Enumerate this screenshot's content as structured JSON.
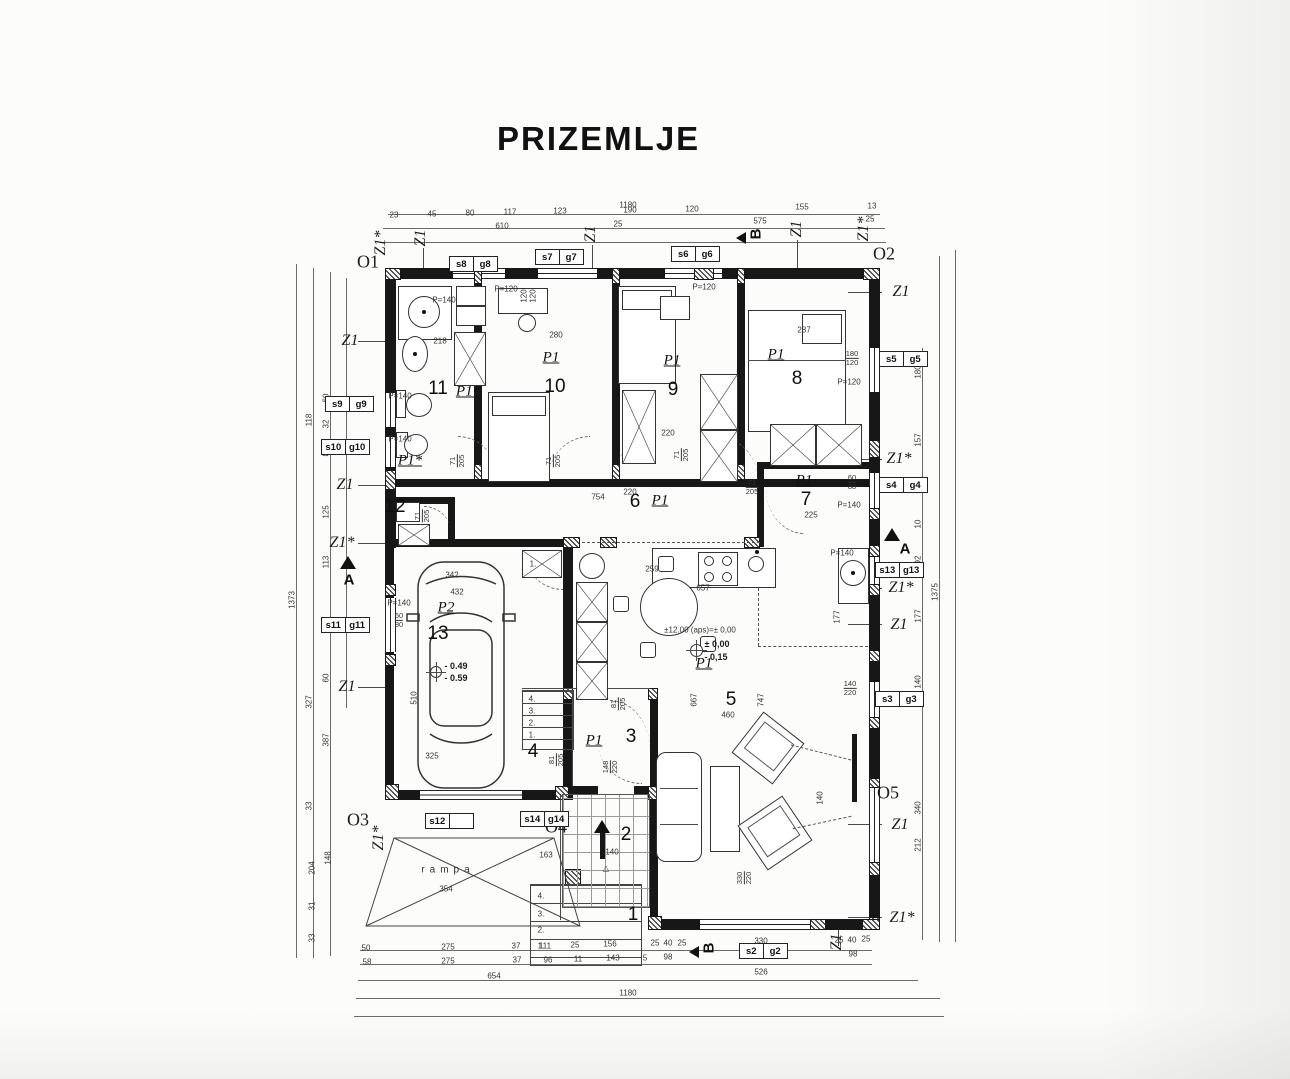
{
  "title": "PRIZEMLJE",
  "plan": {
    "floor_name": "PRIZEMLJE",
    "rooms": [
      {
        "number": "1",
        "type": ""
      },
      {
        "number": "2",
        "type": ""
      },
      {
        "number": "3",
        "type": "P1"
      },
      {
        "number": "4",
        "type": ""
      },
      {
        "number": "5",
        "type": "P1"
      },
      {
        "number": "6",
        "type": "P1"
      },
      {
        "number": "7",
        "type": "P1"
      },
      {
        "number": "8",
        "type": "P1"
      },
      {
        "number": "9",
        "type": "P1"
      },
      {
        "number": "10",
        "type": "P1"
      },
      {
        "number": "11",
        "type": "P1*"
      },
      {
        "number": "12",
        "type": "P1*"
      },
      {
        "number": "13",
        "type": "P2"
      }
    ],
    "ramp_label": "rampa"
  },
  "colors": {
    "ink": "#171717",
    "dim": "#4a4a4a",
    "paper": "#fcfcfb"
  },
  "tags": [
    {
      "a": "s8",
      "b": "g8",
      "x": 450,
      "y": 256
    },
    {
      "a": "s7",
      "b": "g7",
      "x": 536,
      "y": 249
    },
    {
      "a": "s6",
      "b": "g6",
      "x": 672,
      "y": 246
    },
    {
      "a": "s9",
      "b": "g9",
      "x": 326,
      "y": 396
    },
    {
      "a": "s10",
      "b": "g10",
      "x": 322,
      "y": 439
    },
    {
      "a": "s11",
      "b": "g11",
      "x": 322,
      "y": 617
    },
    {
      "a": "s5",
      "b": "g5",
      "x": 880,
      "y": 351
    },
    {
      "a": "s4",
      "b": "g4",
      "x": 880,
      "y": 477
    },
    {
      "a": "s13",
      "b": "g13",
      "x": 876,
      "y": 562
    },
    {
      "a": "s3",
      "b": "g3",
      "x": 876,
      "y": 691
    },
    {
      "a": "s2",
      "b": "g2",
      "x": 740,
      "y": 943
    },
    {
      "a": "s14",
      "b": "g14",
      "x": 521,
      "y": 811
    },
    {
      "a": "s12",
      "b": "",
      "x": 426,
      "y": 813
    }
  ],
  "annotations": [
    {
      "t": "Z1*",
      "x": 381,
      "y": 243,
      "r": -90,
      "c": "z"
    },
    {
      "t": "Z1",
      "x": 421,
      "y": 238,
      "r": -90,
      "c": "z"
    },
    {
      "t": "Z1",
      "x": 591,
      "y": 234,
      "r": -90,
      "c": "z"
    },
    {
      "t": "Z1",
      "x": 797,
      "y": 229,
      "r": -90,
      "c": "z"
    },
    {
      "t": "Z1*",
      "x": 864,
      "y": 229,
      "r": -90,
      "c": "z"
    },
    {
      "t": "Z1",
      "x": 350,
      "y": 341,
      "c": "z"
    },
    {
      "t": "Z1",
      "x": 345,
      "y": 485,
      "c": "z"
    },
    {
      "t": "Z1*",
      "x": 342,
      "y": 543,
      "c": "z"
    },
    {
      "t": "Z1",
      "x": 347,
      "y": 687,
      "c": "z"
    },
    {
      "t": "Z1*",
      "x": 379,
      "y": 838,
      "r": -90,
      "c": "z"
    },
    {
      "t": "Z1",
      "x": 901,
      "y": 292,
      "c": "z"
    },
    {
      "t": "Z1*",
      "x": 899,
      "y": 459,
      "c": "z"
    },
    {
      "t": "Z1*",
      "x": 901,
      "y": 588,
      "c": "z"
    },
    {
      "t": "Z1",
      "x": 899,
      "y": 625,
      "c": "z"
    },
    {
      "t": "Z1",
      "x": 900,
      "y": 825,
      "c": "z"
    },
    {
      "t": "Z1*",
      "x": 902,
      "y": 918,
      "c": "z"
    },
    {
      "t": "Z1",
      "x": 837,
      "y": 942,
      "r": -90,
      "c": "z"
    },
    {
      "t": "O1",
      "x": 368,
      "y": 262,
      "c": "o"
    },
    {
      "t": "O2",
      "x": 884,
      "y": 254,
      "c": "o"
    },
    {
      "t": "O3",
      "x": 358,
      "y": 820,
      "c": "o"
    },
    {
      "t": "O4",
      "x": 556,
      "y": 827,
      "c": "o"
    },
    {
      "t": "O5",
      "x": 888,
      "y": 793,
      "c": "o"
    },
    {
      "t": "A",
      "x": 349,
      "y": 580,
      "c": "s"
    },
    {
      "t": "A",
      "x": 905,
      "y": 549,
      "c": "s"
    },
    {
      "t": "B",
      "x": 756,
      "y": 234,
      "r": -90,
      "c": "s"
    },
    {
      "t": "B",
      "x": 709,
      "y": 948,
      "r": -90,
      "c": "s"
    },
    {
      "t": "P1",
      "x": 551,
      "y": 358,
      "c": "p"
    },
    {
      "t": "P1",
      "x": 672,
      "y": 361,
      "c": "p"
    },
    {
      "t": "P1",
      "x": 776,
      "y": 355,
      "c": "p"
    },
    {
      "t": "P1*",
      "x": 468,
      "y": 392,
      "c": "p"
    },
    {
      "t": "P1*",
      "x": 410,
      "y": 461,
      "c": "p"
    },
    {
      "t": "P1",
      "x": 660,
      "y": 501,
      "c": "p"
    },
    {
      "t": "P1",
      "x": 804,
      "y": 481,
      "c": "p"
    },
    {
      "t": "P2",
      "x": 446,
      "y": 608,
      "c": "p"
    },
    {
      "t": "P1",
      "x": 704,
      "y": 664,
      "c": "p"
    },
    {
      "t": "P1",
      "x": 594,
      "y": 741,
      "c": "p"
    },
    {
      "t": "11",
      "x": 438,
      "y": 389,
      "c": "n"
    },
    {
      "t": "10",
      "x": 555,
      "y": 387,
      "c": "n"
    },
    {
      "t": "9",
      "x": 673,
      "y": 390,
      "c": "n"
    },
    {
      "t": "8",
      "x": 797,
      "y": 379,
      "c": "n"
    },
    {
      "t": "7",
      "x": 806,
      "y": 500,
      "c": "n"
    },
    {
      "t": "6",
      "x": 635,
      "y": 502,
      "c": "n"
    },
    {
      "t": "5",
      "x": 731,
      "y": 700,
      "c": "n"
    },
    {
      "t": "4",
      "x": 533,
      "y": 752,
      "c": "n"
    },
    {
      "t": "3",
      "x": 631,
      "y": 737,
      "c": "n"
    },
    {
      "t": "2",
      "x": 626,
      "y": 835,
      "c": "n"
    },
    {
      "t": "1",
      "x": 633,
      "y": 915,
      "c": "n"
    },
    {
      "t": "12",
      "x": 395,
      "y": 507,
      "c": "n"
    },
    {
      "t": "13",
      "x": 438,
      "y": 634,
      "c": "n"
    },
    {
      "t": "1180",
      "x": 628,
      "y": 205,
      "c": "d"
    },
    {
      "t": "23",
      "x": 394,
      "y": 215,
      "c": "d"
    },
    {
      "t": "45",
      "x": 432,
      "y": 214,
      "c": "d"
    },
    {
      "t": "80",
      "x": 470,
      "y": 213,
      "c": "d"
    },
    {
      "t": "117",
      "x": 510,
      "y": 212,
      "c": "d"
    },
    {
      "t": "123",
      "x": 560,
      "y": 211,
      "c": "d"
    },
    {
      "t": "190",
      "x": 630,
      "y": 210,
      "c": "d"
    },
    {
      "t": "120",
      "x": 692,
      "y": 209,
      "c": "d"
    },
    {
      "t": "155",
      "x": 802,
      "y": 207,
      "c": "d"
    },
    {
      "t": "13",
      "x": 872,
      "y": 206,
      "c": "d"
    },
    {
      "t": "610",
      "x": 502,
      "y": 226,
      "c": "d"
    },
    {
      "t": "25",
      "x": 618,
      "y": 224,
      "c": "d"
    },
    {
      "t": "575",
      "x": 760,
      "y": 221,
      "c": "d"
    },
    {
      "t": "25",
      "x": 870,
      "y": 219,
      "c": "d"
    },
    {
      "t": "50",
      "x": 366,
      "y": 948,
      "c": "d"
    },
    {
      "t": "275",
      "x": 448,
      "y": 947,
      "c": "d"
    },
    {
      "t": "37",
      "x": 516,
      "y": 946,
      "c": "d"
    },
    {
      "t": "111",
      "x": 545,
      "y": 946,
      "c": "d"
    },
    {
      "t": "25",
      "x": 575,
      "y": 945,
      "c": "d"
    },
    {
      "t": "156",
      "x": 610,
      "y": 944,
      "c": "d"
    },
    {
      "t": "25",
      "x": 655,
      "y": 943,
      "c": "d"
    },
    {
      "t": "40",
      "x": 668,
      "y": 943,
      "c": "d"
    },
    {
      "t": "25",
      "x": 682,
      "y": 943,
      "c": "d"
    },
    {
      "t": "330",
      "x": 761,
      "y": 941,
      "c": "d"
    },
    {
      "t": "25",
      "x": 839,
      "y": 940,
      "c": "d"
    },
    {
      "t": "40",
      "x": 852,
      "y": 940,
      "c": "d"
    },
    {
      "t": "25",
      "x": 866,
      "y": 939,
      "c": "d"
    },
    {
      "t": "58",
      "x": 367,
      "y": 962,
      "c": "d"
    },
    {
      "t": "275",
      "x": 448,
      "y": 961,
      "c": "d"
    },
    {
      "t": "37",
      "x": 517,
      "y": 960,
      "c": "d"
    },
    {
      "t": "96",
      "x": 548,
      "y": 960,
      "c": "d"
    },
    {
      "t": "11",
      "x": 578,
      "y": 959,
      "c": "d"
    },
    {
      "t": "143",
      "x": 613,
      "y": 958,
      "c": "d"
    },
    {
      "t": "5",
      "x": 645,
      "y": 958,
      "c": "d"
    },
    {
      "t": "98",
      "x": 668,
      "y": 957,
      "c": "d"
    },
    {
      "t": "330",
      "x": 761,
      "y": 956,
      "c": "d"
    },
    {
      "t": "98",
      "x": 853,
      "y": 954,
      "c": "d"
    },
    {
      "t": "654",
      "x": 494,
      "y": 976,
      "c": "d"
    },
    {
      "t": "526",
      "x": 761,
      "y": 972,
      "c": "d"
    },
    {
      "t": "1180",
      "x": 628,
      "y": 993,
      "c": "d"
    },
    {
      "t": "1373",
      "x": 292,
      "y": 600,
      "r": -90,
      "c": "d"
    },
    {
      "t": "118",
      "x": 309,
      "y": 420,
      "r": -90,
      "c": "d"
    },
    {
      "t": "327",
      "x": 309,
      "y": 702,
      "r": -90,
      "c": "d"
    },
    {
      "t": "33",
      "x": 309,
      "y": 806,
      "r": -90,
      "c": "d"
    },
    {
      "t": "204",
      "x": 312,
      "y": 868,
      "r": -90,
      "c": "d"
    },
    {
      "t": "31",
      "x": 312,
      "y": 906,
      "r": -90,
      "c": "d"
    },
    {
      "t": "33",
      "x": 312,
      "y": 938,
      "r": -90,
      "c": "d"
    },
    {
      "t": "60",
      "x": 326,
      "y": 398,
      "r": -90,
      "c": "d"
    },
    {
      "t": "32",
      "x": 326,
      "y": 424,
      "r": -90,
      "c": "d"
    },
    {
      "t": "80",
      "x": 326,
      "y": 452,
      "r": -90,
      "c": "d"
    },
    {
      "t": "125",
      "x": 326,
      "y": 512,
      "r": -90,
      "c": "d"
    },
    {
      "t": "113",
      "x": 326,
      "y": 562,
      "r": -90,
      "c": "d"
    },
    {
      "t": "98",
      "x": 326,
      "y": 622,
      "r": -90,
      "c": "d"
    },
    {
      "t": "60",
      "x": 326,
      "y": 678,
      "r": -90,
      "c": "d"
    },
    {
      "t": "387",
      "x": 326,
      "y": 740,
      "r": -90,
      "c": "d"
    },
    {
      "t": "148",
      "x": 328,
      "y": 858,
      "r": -90,
      "c": "d"
    },
    {
      "t": "180",
      "x": 918,
      "y": 372,
      "r": -90,
      "c": "d"
    },
    {
      "t": "157",
      "x": 918,
      "y": 440,
      "r": -90,
      "c": "d"
    },
    {
      "t": "60",
      "x": 918,
      "y": 489,
      "r": -90,
      "c": "d"
    },
    {
      "t": "10",
      "x": 918,
      "y": 524,
      "r": -90,
      "c": "d"
    },
    {
      "t": "92",
      "x": 918,
      "y": 560,
      "r": -90,
      "c": "d"
    },
    {
      "t": "177",
      "x": 918,
      "y": 616,
      "r": -90,
      "c": "d"
    },
    {
      "t": "140",
      "x": 918,
      "y": 682,
      "r": -90,
      "c": "d"
    },
    {
      "t": "340",
      "x": 918,
      "y": 808,
      "r": -90,
      "c": "d"
    },
    {
      "t": "212",
      "x": 918,
      "y": 845,
      "r": -90,
      "c": "d"
    },
    {
      "t": "1375",
      "x": 935,
      "y": 592,
      "r": -90,
      "c": "d"
    },
    {
      "t": "P=140",
      "x": 444,
      "y": 300,
      "c": "d"
    },
    {
      "t": "P=120",
      "x": 506,
      "y": 289,
      "c": "d"
    },
    {
      "t": "120",
      "x": 524,
      "y": 296,
      "r": -90,
      "c": "d"
    },
    {
      "t": "120",
      "x": 533,
      "y": 296,
      "r": -90,
      "c": "d"
    },
    {
      "t": "P=120",
      "x": 704,
      "y": 287,
      "c": "d"
    },
    {
      "t": "280",
      "x": 556,
      "y": 335,
      "c": "d"
    },
    {
      "t": "287",
      "x": 804,
      "y": 330,
      "c": "d"
    },
    {
      "t": "218",
      "x": 440,
      "y": 341,
      "c": "d"
    },
    {
      "t": "220",
      "x": 668,
      "y": 433,
      "c": "d"
    },
    {
      "t": "220",
      "x": 630,
      "y": 492,
      "c": "d"
    },
    {
      "t": "754",
      "x": 598,
      "y": 497,
      "c": "d"
    },
    {
      "t": "P=140",
      "x": 400,
      "y": 396,
      "c": "d"
    },
    {
      "t": "P=140",
      "x": 400,
      "y": 439,
      "c": "d"
    },
    {
      "t": "P=120",
      "x": 849,
      "y": 382,
      "c": "d"
    },
    {
      "t": "P=140",
      "x": 849,
      "y": 505,
      "c": "d"
    },
    {
      "t": "P=140",
      "x": 399,
      "y": 603,
      "c": "d"
    },
    {
      "t": "P=140",
      "x": 842,
      "y": 553,
      "c": "d"
    },
    {
      "t": "342",
      "x": 452,
      "y": 575,
      "c": "d"
    },
    {
      "t": "432",
      "x": 457,
      "y": 592,
      "c": "d"
    },
    {
      "t": "325",
      "x": 432,
      "y": 756,
      "c": "d"
    },
    {
      "t": "510",
      "x": 414,
      "y": 698,
      "r": -90,
      "c": "d"
    },
    {
      "t": "259",
      "x": 652,
      "y": 569,
      "c": "d"
    },
    {
      "t": "657",
      "x": 703,
      "y": 588,
      "c": "d"
    },
    {
      "t": "460",
      "x": 728,
      "y": 715,
      "c": "d"
    },
    {
      "t": "667",
      "x": 694,
      "y": 700,
      "r": -90,
      "c": "d"
    },
    {
      "t": "747",
      "x": 761,
      "y": 700,
      "r": -90,
      "c": "d"
    },
    {
      "t": "177",
      "x": 837,
      "y": 617,
      "r": -90,
      "c": "d"
    },
    {
      "t": "140",
      "x": 820,
      "y": 798,
      "r": -90,
      "c": "d"
    },
    {
      "t": "225",
      "x": 811,
      "y": 515,
      "c": "d"
    },
    {
      "t": "163",
      "x": 546,
      "y": 855,
      "c": "d"
    },
    {
      "t": "140",
      "x": 612,
      "y": 852,
      "c": "d"
    },
    {
      "t": "354",
      "x": 446,
      "y": 889,
      "c": "d"
    },
    {
      "t": "rampa",
      "x": 448,
      "y": 870,
      "c": "r"
    },
    {
      "t": "4.",
      "x": 532,
      "y": 699,
      "c": "d"
    },
    {
      "t": "3.",
      "x": 532,
      "y": 711,
      "c": "d"
    },
    {
      "t": "2.",
      "x": 532,
      "y": 723,
      "c": "d"
    },
    {
      "t": "1.",
      "x": 532,
      "y": 735,
      "c": "d"
    },
    {
      "t": "1.",
      "x": 533,
      "y": 564,
      "c": "d"
    },
    {
      "t": "4.",
      "x": 541,
      "y": 896,
      "c": "d"
    },
    {
      "t": "3.",
      "x": 541,
      "y": 914,
      "c": "d"
    },
    {
      "t": "2.",
      "x": 541,
      "y": 930,
      "c": "d"
    },
    {
      "t": "1.",
      "x": 541,
      "y": 946,
      "c": "d"
    },
    {
      "t": "△",
      "x": 606,
      "y": 868,
      "c": "d"
    },
    {
      "t": "±12.00 (aps)=± 0,00",
      "x": 700,
      "y": 630,
      "c": "d"
    },
    {
      "t": "± 0,00",
      "x": 717,
      "y": 644,
      "c": "e"
    },
    {
      "t": "- 0,15",
      "x": 716,
      "y": 657,
      "c": "e"
    },
    {
      "t": "- 0.49",
      "x": 456,
      "y": 666,
      "c": "e"
    },
    {
      "t": "- 0.59",
      "x": 456,
      "y": 678,
      "c": "e"
    },
    {
      "f": [
        "71",
        "205"
      ],
      "x": 424,
      "y": 516,
      "r": -90
    },
    {
      "f": [
        "71",
        "205"
      ],
      "x": 459,
      "y": 461,
      "r": -90
    },
    {
      "f": [
        "71",
        "205"
      ],
      "x": 555,
      "y": 461,
      "r": -90
    },
    {
      "f": [
        "71",
        "205"
      ],
      "x": 683,
      "y": 455,
      "r": -90
    },
    {
      "f": [
        "71",
        "205"
      ],
      "x": 752,
      "y": 489
    },
    {
      "f": [
        "81",
        "205"
      ],
      "x": 620,
      "y": 704,
      "r": -90
    },
    {
      "f": [
        "81",
        "205"
      ],
      "x": 558,
      "y": 760,
      "r": -90
    },
    {
      "f": [
        "148",
        "220"
      ],
      "x": 612,
      "y": 767,
      "r": -90
    },
    {
      "f": [
        "330",
        "220"
      ],
      "x": 746,
      "y": 878,
      "r": -90
    },
    {
      "f": [
        "180",
        "120"
      ],
      "x": 852,
      "y": 360
    },
    {
      "f": [
        "60",
        "80"
      ],
      "x": 852,
      "y": 484
    },
    {
      "f": [
        "140",
        "220"
      ],
      "x": 850,
      "y": 690
    },
    {
      "f": [
        "60",
        "80"
      ],
      "x": 399,
      "y": 622
    }
  ]
}
